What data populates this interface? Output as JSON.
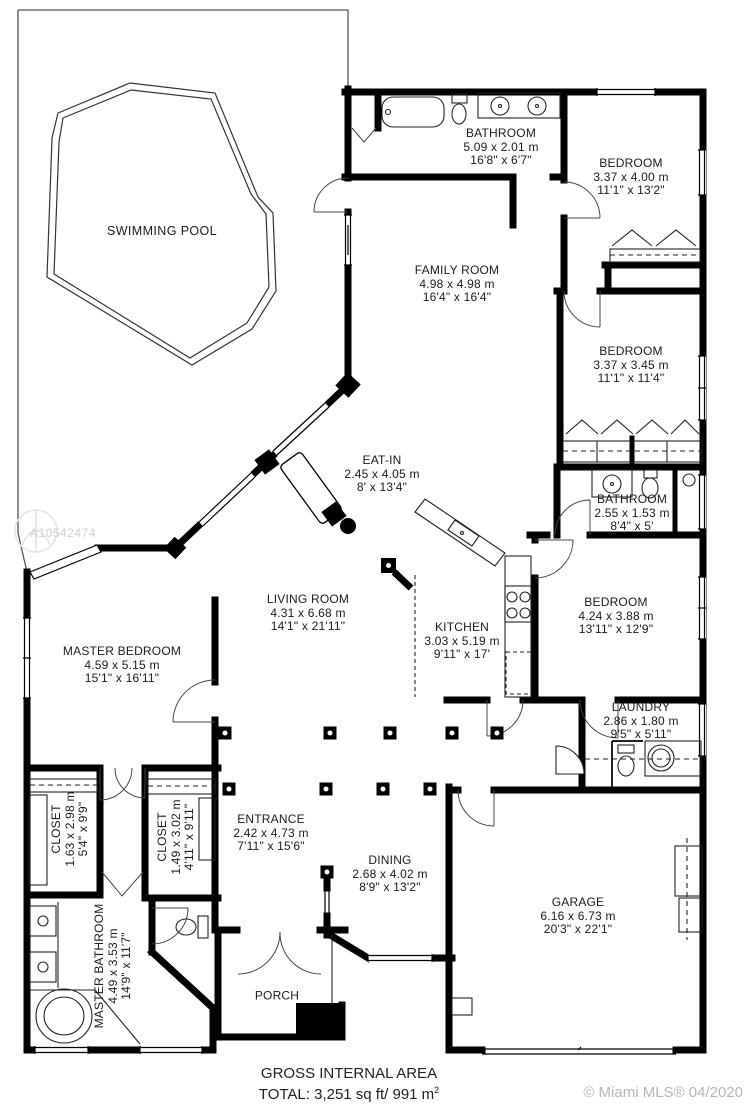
{
  "pool": {
    "label": "SWIMMING POOL"
  },
  "rooms": [
    {
      "name": "SWIMMING POOL",
      "metric": "",
      "imperial": ""
    },
    {
      "name": "BATHROOM",
      "metric": "5.09 x 2.01 m",
      "imperial": "16'8\" x 6'7\""
    },
    {
      "name": "BEDROOM",
      "metric": "3.37 x 4.00 m",
      "imperial": "11'1\" x 13'2\""
    },
    {
      "name": "FAMILY ROOM",
      "metric": "4.98 x 4.98 m",
      "imperial": "16'4\" x 16'4\""
    },
    {
      "name": "BEDROOM",
      "metric": "3.37 x 3.45 m",
      "imperial": "11'1\" x 11'4\""
    },
    {
      "name": "EAT-IN",
      "metric": "2.45 x 4.05 m",
      "imperial": "8' x 13'4\""
    },
    {
      "name": "BATHROOM",
      "metric": "2.55 x 1.53 m",
      "imperial": "8'4\" x 5'"
    },
    {
      "name": "LIVING ROOM",
      "metric": "4.31 x 6.68 m",
      "imperial": "14'1\" x 21'11\""
    },
    {
      "name": "KITCHEN",
      "metric": "3.03 x 5.19 m",
      "imperial": "9'11\" x 17'"
    },
    {
      "name": "BEDROOM",
      "metric": "4.24 x 3.88 m",
      "imperial": "13'11\" x 12'9\""
    },
    {
      "name": "MASTER BEDROOM",
      "metric": "4.59 x 5.15 m",
      "imperial": "15'1\" x 16'11\""
    },
    {
      "name": "LAUNDRY",
      "metric": "2.86 x 1.80 m",
      "imperial": "9'5\" x 5'11\""
    },
    {
      "name": "CLOSET",
      "metric": "1.63 x 2.98 m",
      "imperial": "5'4\" x 9'9\""
    },
    {
      "name": "CLOSET",
      "metric": "1.49 x 3.02 m",
      "imperial": "4'11\" x 9'11\""
    },
    {
      "name": "ENTRANCE",
      "metric": "2.42 x 4.73 m",
      "imperial": "7'11\" x 15'6\""
    },
    {
      "name": "DINING",
      "metric": "2.68 x 4.02 m",
      "imperial": "8'9\" x 13'2\""
    },
    {
      "name": "MASTER BATHROOM",
      "metric": "4.49 x 3.53 m",
      "imperial": "14'9\" x 11'7\""
    },
    {
      "name": "PORCH",
      "metric": "",
      "imperial": ""
    },
    {
      "name": "GARAGE",
      "metric": "6.16 x 6.73 m",
      "imperial": "20'3\" x 22'1\""
    }
  ],
  "footer": {
    "line1": "GROSS INTERNAL AREA",
    "line2": "TOTAL: 3,251 sq ft/ 991 m",
    "line2_sup": "2"
  },
  "watermarks": {
    "listing_id": "A10542474",
    "credit": "© Miami MLS® 04/2020"
  }
}
